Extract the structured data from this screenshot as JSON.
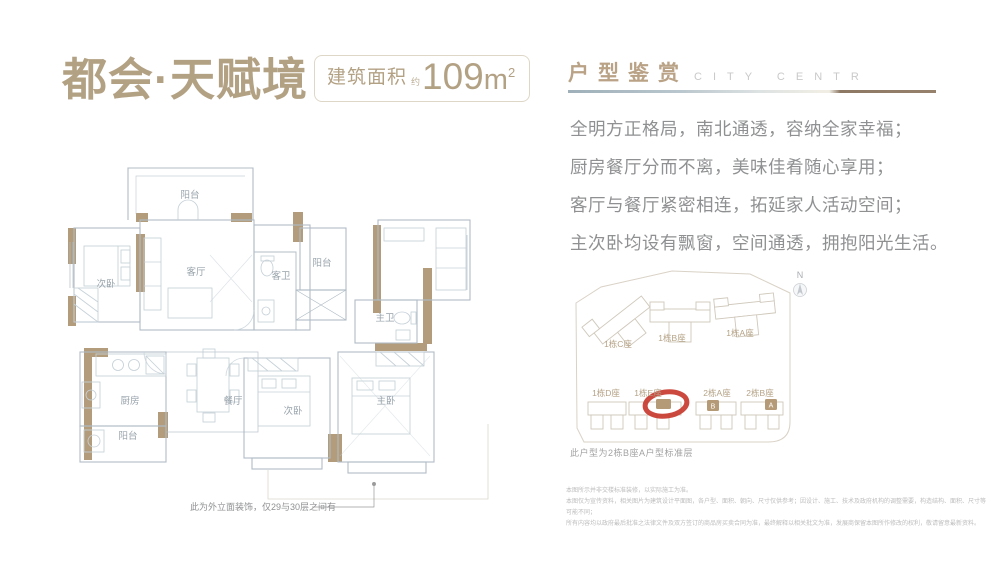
{
  "left": {
    "title": "都会·天赋境",
    "area": {
      "label": "建筑面积",
      "approx": "约",
      "number": "109",
      "unit": "m",
      "sup": "2"
    },
    "floorplan": {
      "rooms": {
        "balcony_top": "阳台",
        "bedroom_tl": "次卧",
        "living": "客厅",
        "guest_bath": "客卫",
        "balcony_mid": "阳台",
        "master_bath": "主卫",
        "kitchen": "厨房",
        "dining": "餐厅",
        "balcony_bottom": "阳台",
        "bedroom_b": "次卧",
        "master": "主卧"
      },
      "note": "此为外立面装饰，仅29与30层之间有"
    }
  },
  "right": {
    "header": {
      "cn": "户型鉴赏",
      "en": "CITY CENTR"
    },
    "description": [
      "全明方正格局，南北通透，容纳全家幸福；",
      "厨房餐厅分而不离，美味佳肴随心享用；",
      "客厅与餐厅紧密相连，拓延家人活动空间；",
      "主次卧均设有飘窗，空间通透，拥抱阳光生活。"
    ],
    "siteplan": {
      "compass": "N",
      "buildings": [
        "1栋C座",
        "1栋B座",
        "1栋A座",
        "1栋D座",
        "1栋E座",
        "2栋A座",
        "2栋B座"
      ],
      "unit_markers": [
        "B",
        "A"
      ],
      "caption": "此户型为2栋B座A户型标准层"
    },
    "disclaimer": [
      "本图所示并非交楼标准装修，以实际施工为准。",
      "本图仅为宣传资料，相关图片为建筑设计平面图，各户型、面积、朝向、尺寸仅供参考；因设计、施工、技术及政府机构的调整需要，构造结构、面积、尺寸等可能不同；",
      "所有内容均以政府最后批准之法律文件及双方签订的商品房买卖合同为准，最终解释以相关批文为准，发展商保留本图所作修改的权利，敬请留意最新资料。"
    ]
  },
  "colors": {
    "accent_tan": "#b3a184",
    "wall_tan": "#b29c7c",
    "plan_line": "#b0bcc6",
    "highlight_red": "#c8392f"
  }
}
